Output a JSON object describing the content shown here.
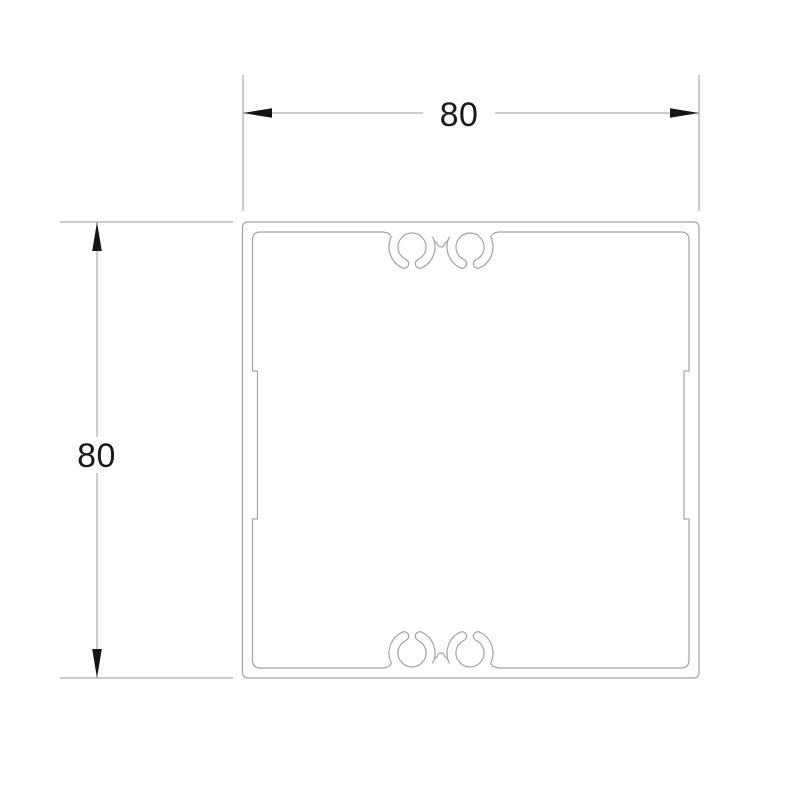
{
  "drawing": {
    "type_label": "aluminium-profile-cross-section",
    "width_dim": {
      "value": "80"
    },
    "height_dim": {
      "value": "80"
    },
    "colors": {
      "profile_line": "#a3a3a3",
      "dimension_line": "#9a9a9a",
      "arrow_fill": "#141414",
      "text_color": "#1a1a1a",
      "background": "#ffffff"
    }
  }
}
